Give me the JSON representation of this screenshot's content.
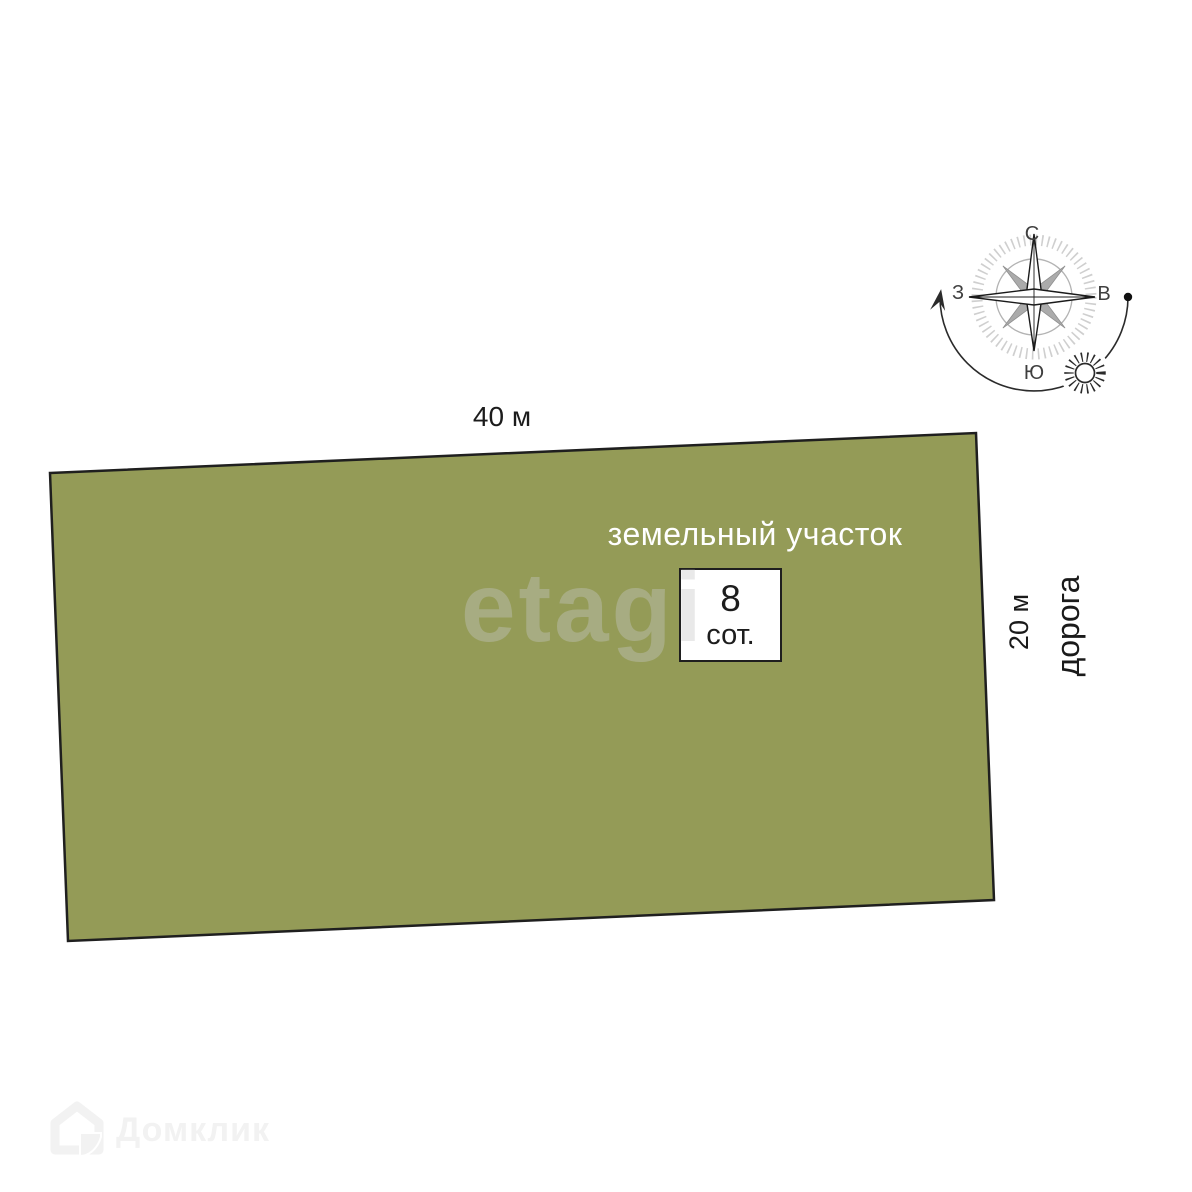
{
  "plan": {
    "top_dimension": "40 м",
    "parcel_label": "земельный участок",
    "area_value": "8",
    "area_unit": "сот.",
    "right_dimension": "20 м",
    "road_label": "дорога"
  },
  "compass": {
    "north": "С",
    "south": "Ю",
    "west": "З",
    "east": "В"
  },
  "watermarks": {
    "etagi": "etagi",
    "domclick": "Домклик"
  },
  "colors": {
    "parcel_fill": "#949b57",
    "parcel_stroke": "#1f1f1f",
    "label_dark": "#1a1a1a",
    "label_white": "#ffffff",
    "watermark_gray": "#c8c8c8",
    "domclick_gray": "#f2f2f2"
  }
}
